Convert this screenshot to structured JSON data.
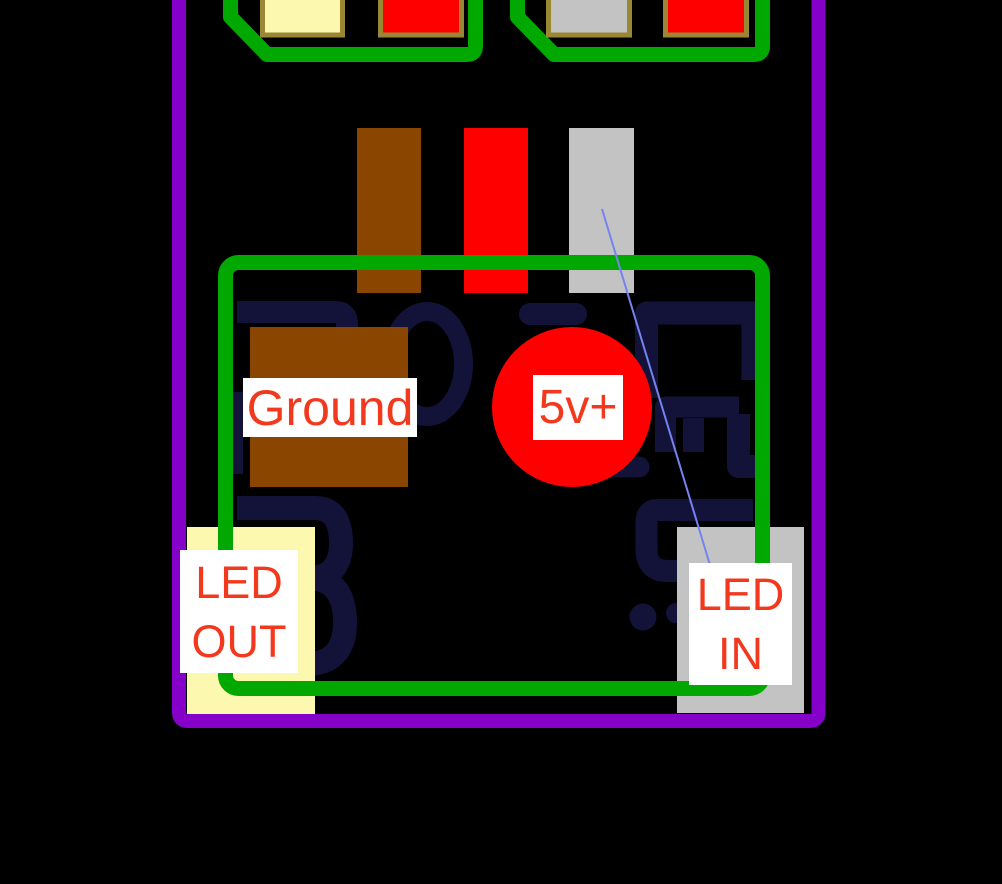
{
  "diagram": {
    "description": "PCB pad wiring diagram",
    "labels": {
      "ground": {
        "text": "Ground"
      },
      "power": {
        "text": "5v+"
      },
      "led_out": {
        "line1": "LED",
        "line2": "OUT"
      },
      "led_in": {
        "line1": "LED",
        "line2": "IN"
      }
    },
    "colors": {
      "background": "#000000",
      "board_outline_purple": "#8500c8",
      "trace_green": "#00a800",
      "silkscreen_navy": "#131339",
      "pad_cream": "#fdf8b0",
      "pad_gray": "#c3c3c3",
      "pad_red": "#ff0000",
      "pad_brown": "#8a4500",
      "pad_border_olive": "#9a8733",
      "label_text_red": "#f2391d",
      "leader_line_blue": "#7583f0"
    }
  }
}
